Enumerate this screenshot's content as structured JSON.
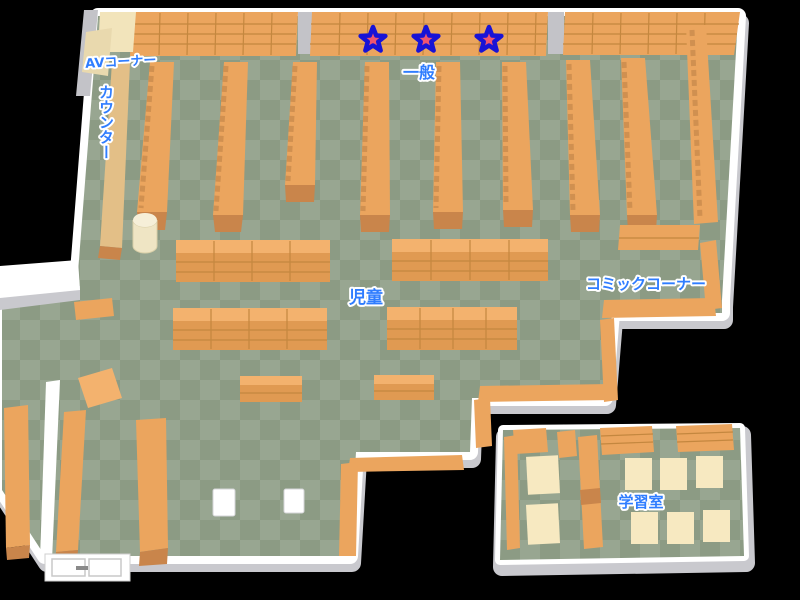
{
  "map": {
    "labels": {
      "av_corner": "AVコーナー",
      "counter": "カウンター",
      "general": "一般",
      "children": "児童",
      "comic_corner": "コミックコーナー",
      "study_room": "学習室"
    },
    "markers": {
      "star_count": 3
    },
    "colors": {
      "background": "#000000",
      "floor_light": "#98a691",
      "floor_dark": "#8c9b84",
      "wall": "#ffffff",
      "wall_shade": "#c9c9ce",
      "shelf": "#eba55e",
      "shelf_top": "#f3b26e",
      "shelf_front": "#e09a52",
      "shelf_dark": "#c9854b",
      "counter": "#e3bf87",
      "cream": "#f2e4bb",
      "desk": "#f7e9c1",
      "label_text": "#2f7dff",
      "label_outline": "#ffffff",
      "star_fill": "#ee5570",
      "star_stroke": "#1813d6"
    }
  }
}
